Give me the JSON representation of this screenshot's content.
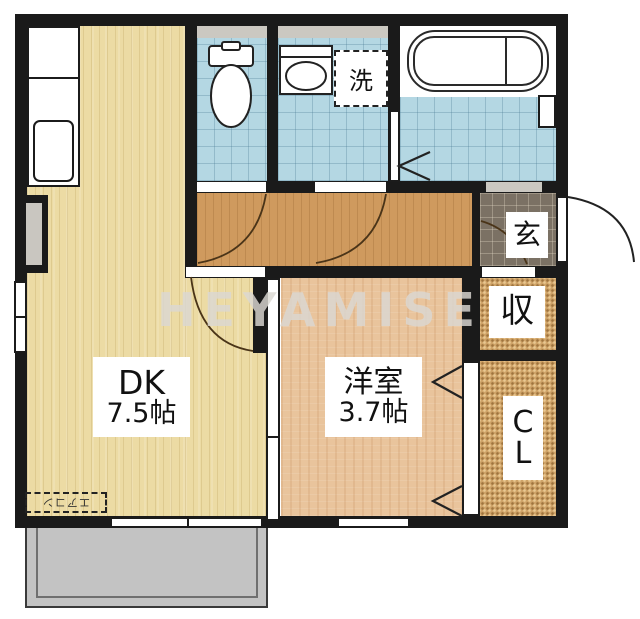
{
  "watermark": {
    "text": "HEYAMISE"
  },
  "rooms": {
    "dk": {
      "name": "DK",
      "size": "7.5帖"
    },
    "western": {
      "name": "洋室",
      "size": "3.7帖"
    },
    "entrance": {
      "label": "玄"
    },
    "storage": {
      "label": "収"
    },
    "closet": {
      "line1": "C",
      "line2": "L"
    }
  },
  "fixtures": {
    "laundry_label": "洗",
    "aircon_label": "エアコン"
  },
  "colors": {
    "wall": "#1a1a1a",
    "dk_floor": "#ecdba4",
    "western_floor": "#e9c49c",
    "hall_floor": "#cf9a5e",
    "tile_blue": "#b4d7e3",
    "entry_tile": "#7b7164",
    "storage_weave": "#cfa368",
    "balcony": "#c3c3c3",
    "lintel": "#cbc8c1",
    "watermark": "#dbd8d3",
    "label_bg": "#ffffff",
    "line": "#222222"
  }
}
